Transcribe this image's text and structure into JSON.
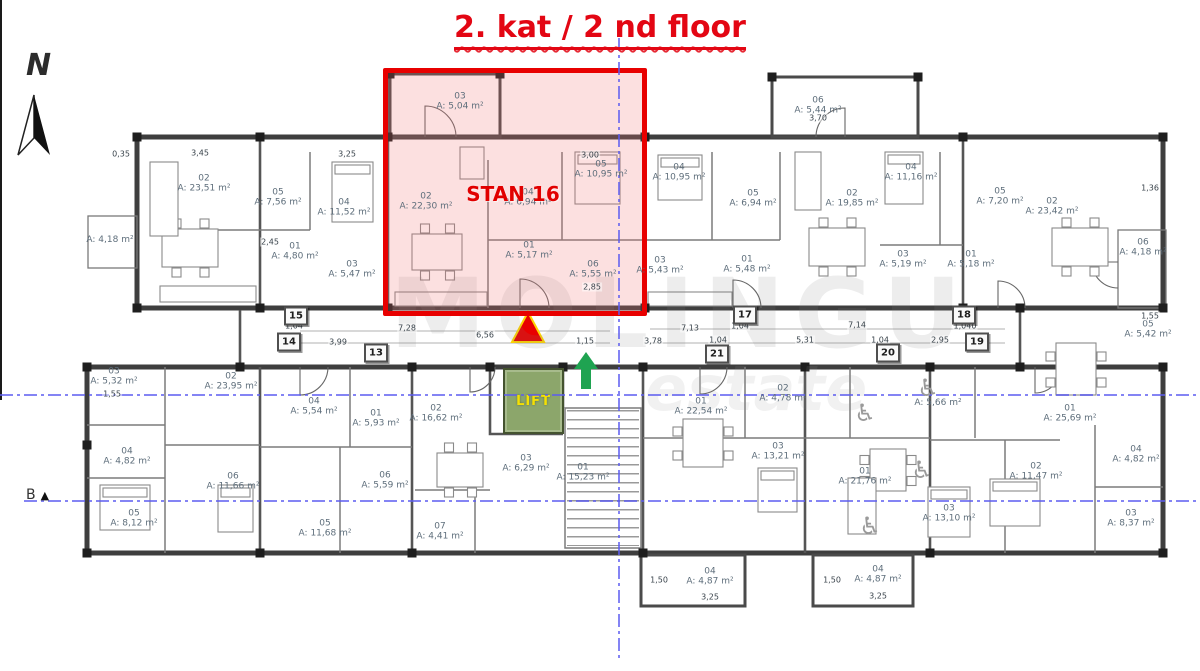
{
  "title": "2. kat / 2 nd floor",
  "compass": {
    "label": "N"
  },
  "highlight": {
    "label": "STAN 16"
  },
  "lift": {
    "label": "LIFT"
  },
  "section_marker": {
    "label": "B",
    "symbol": "▲"
  },
  "watermark": {
    "line1": "MOLINGU",
    "line2": "estate"
  },
  "colors": {
    "highlight_red": "#e80000",
    "highlight_fill": "rgba(242,116,116,0.22)",
    "title_red": "#e30613",
    "lift_green": "#8ca66b",
    "lift_label_yellow": "#f5e003",
    "axis_blue": "#5b5bf0",
    "wall_dark": "#3e3e3e",
    "marker_arrow_green": "#1fa351",
    "marker_triangle_red": "#e80000",
    "marker_triangle_outline": "#ffd400"
  },
  "unit_tags": [
    {
      "label": "15",
      "x": 296,
      "y": 316
    },
    {
      "label": "14",
      "x": 289,
      "y": 342
    },
    {
      "label": "13",
      "x": 376,
      "y": 353
    },
    {
      "label": "17",
      "x": 745,
      "y": 315
    },
    {
      "label": "21",
      "x": 717,
      "y": 354
    },
    {
      "label": "18",
      "x": 964,
      "y": 315
    },
    {
      "label": "19",
      "x": 977,
      "y": 342
    },
    {
      "label": "20",
      "x": 888,
      "y": 353
    }
  ],
  "rooms": [
    {
      "num": "02",
      "area": "A: 23,51 m²",
      "x": 204,
      "y": 184
    },
    {
      "num": "05",
      "area": "A: 7,56 m²",
      "x": 278,
      "y": 198
    },
    {
      "num": "04",
      "area": "A: 11,52 m²",
      "x": 344,
      "y": 208
    },
    {
      "num": "01",
      "area": "A: 4,80 m²",
      "x": 295,
      "y": 252
    },
    {
      "num": "03",
      "area": "A: 5,47 m²",
      "x": 352,
      "y": 270
    },
    {
      "num": "",
      "area": "A: 4,18 m²",
      "x": 110,
      "y": 240
    },
    {
      "num": "03",
      "area": "A: 5,04 m²",
      "x": 460,
      "y": 102
    },
    {
      "num": "02",
      "area": "A: 22,30 m²",
      "x": 426,
      "y": 202
    },
    {
      "num": "05",
      "area": "A: 10,95 m²",
      "x": 601,
      "y": 170
    },
    {
      "num": "04",
      "area": "A: 6,94 m²",
      "x": 528,
      "y": 198
    },
    {
      "num": "01",
      "area": "A: 5,17 m²",
      "x": 529,
      "y": 251
    },
    {
      "num": "06",
      "area": "A: 5,55 m²",
      "x": 593,
      "y": 270
    },
    {
      "num": "06",
      "area": "A: 5,44 m²",
      "x": 818,
      "y": 106
    },
    {
      "num": "04",
      "area": "A: 10,95 m²",
      "x": 679,
      "y": 173
    },
    {
      "num": "05",
      "area": "A: 6,94 m²",
      "x": 753,
      "y": 199
    },
    {
      "num": "02",
      "area": "A: 19,85 m²",
      "x": 852,
      "y": 199
    },
    {
      "num": "03",
      "area": "A: 5,43 m²",
      "x": 660,
      "y": 266
    },
    {
      "num": "01",
      "area": "A: 5,48 m²",
      "x": 747,
      "y": 265
    },
    {
      "num": "04",
      "area": "A: 11,16 m²",
      "x": 911,
      "y": 173
    },
    {
      "num": "05",
      "area": "A: 7,20 m²",
      "x": 1000,
      "y": 197
    },
    {
      "num": "02",
      "area": "A: 23,42 m²",
      "x": 1052,
      "y": 207
    },
    {
      "num": "03",
      "area": "A: 5,19 m²",
      "x": 903,
      "y": 260
    },
    {
      "num": "01",
      "area": "A: 5,18 m²",
      "x": 971,
      "y": 260
    },
    {
      "num": "06",
      "area": "A: 4,18 m²",
      "x": 1143,
      "y": 248
    },
    {
      "num": "03",
      "area": "A: 5,32 m²",
      "x": 114,
      "y": 377
    },
    {
      "num": "02",
      "area": "A: 23,95 m²",
      "x": 231,
      "y": 382
    },
    {
      "num": "04",
      "area": "A: 4,82 m²",
      "x": 127,
      "y": 457
    },
    {
      "num": "06",
      "area": "A: 11,66 m²",
      "x": 233,
      "y": 482
    },
    {
      "num": "05",
      "area": "A: 8,12 m²",
      "x": 134,
      "y": 519
    },
    {
      "num": "04",
      "area": "A: 5,54 m²",
      "x": 314,
      "y": 407
    },
    {
      "num": "01",
      "area": "A: 5,93 m²",
      "x": 376,
      "y": 419
    },
    {
      "num": "02",
      "area": "A: 16,62 m²",
      "x": 436,
      "y": 414
    },
    {
      "num": "06",
      "area": "A: 5,59 m²",
      "x": 385,
      "y": 481
    },
    {
      "num": "05",
      "area": "A: 11,68 m²",
      "x": 325,
      "y": 529
    },
    {
      "num": "07",
      "area": "A: 4,41 m²",
      "x": 440,
      "y": 532
    },
    {
      "num": "03",
      "area": "A: 6,29 m²",
      "x": 526,
      "y": 464
    },
    {
      "num": "01",
      "area": "A: 15,23 m²",
      "x": 583,
      "y": 473
    },
    {
      "num": "01",
      "area": "A: 22,54 m²",
      "x": 701,
      "y": 407
    },
    {
      "num": "02",
      "area": "A: 4,78 m²",
      "x": 783,
      "y": 394
    },
    {
      "num": "03",
      "area": "A: 13,21 m²",
      "x": 778,
      "y": 452
    },
    {
      "num": "01",
      "area": "A: 21,76 m²",
      "x": 865,
      "y": 477
    },
    {
      "num": "04",
      "area": "A: 4,87 m²",
      "x": 710,
      "y": 577
    },
    {
      "num": "04",
      "area": "A: 4,87 m²",
      "x": 878,
      "y": 575
    },
    {
      "num": "",
      "area": "A: 5,66 m²",
      "x": 938,
      "y": 403
    },
    {
      "num": "01",
      "area": "A: 25,69 m²",
      "x": 1070,
      "y": 414
    },
    {
      "num": "02",
      "area": "A: 11,47 m²",
      "x": 1036,
      "y": 472
    },
    {
      "num": "03",
      "area": "A: 13,10 m²",
      "x": 949,
      "y": 514
    },
    {
      "num": "04",
      "area": "A: 4,82 m²",
      "x": 1136,
      "y": 455
    },
    {
      "num": "03",
      "area": "A: 8,37 m²",
      "x": 1131,
      "y": 519
    },
    {
      "num": "05",
      "area": "A: 5,42 m²",
      "x": 1148,
      "y": 330
    }
  ],
  "dims": [
    {
      "label": "1,04",
      "x": 294,
      "y": 326
    },
    {
      "label": "7,28",
      "x": 407,
      "y": 328
    },
    {
      "label": "6,56",
      "x": 485,
      "y": 335
    },
    {
      "label": "3,99",
      "x": 338,
      "y": 342
    },
    {
      "label": "1,15",
      "x": 585,
      "y": 341
    },
    {
      "label": "7,13",
      "x": 690,
      "y": 328
    },
    {
      "label": "1,04",
      "x": 740,
      "y": 326
    },
    {
      "label": "7,14",
      "x": 857,
      "y": 325
    },
    {
      "label": "1,040",
      "x": 965,
      "y": 326
    },
    {
      "label": "3,78",
      "x": 653,
      "y": 341
    },
    {
      "label": "1,04",
      "x": 718,
      "y": 340
    },
    {
      "label": "5,31",
      "x": 805,
      "y": 340
    },
    {
      "label": "1,04",
      "x": 880,
      "y": 340
    },
    {
      "label": "2,95",
      "x": 940,
      "y": 340
    },
    {
      "label": "3,70",
      "x": 818,
      "y": 118
    },
    {
      "label": "3,00",
      "x": 590,
      "y": 155
    },
    {
      "label": "2,85",
      "x": 592,
      "y": 287
    },
    {
      "label": "0,35",
      "x": 121,
      "y": 154
    },
    {
      "label": "3,45",
      "x": 200,
      "y": 153
    },
    {
      "label": "3,25",
      "x": 347,
      "y": 154
    },
    {
      "label": "2,45",
      "x": 270,
      "y": 242
    },
    {
      "label": "1,36",
      "x": 1150,
      "y": 188
    },
    {
      "label": "1,55",
      "x": 1150,
      "y": 316
    },
    {
      "label": "1,55",
      "x": 112,
      "y": 394
    },
    {
      "label": "1,50",
      "x": 659,
      "y": 580
    },
    {
      "label": "3,25",
      "x": 710,
      "y": 597
    },
    {
      "label": "1,50",
      "x": 832,
      "y": 580
    },
    {
      "label": "3,25",
      "x": 878,
      "y": 596
    }
  ],
  "wheelchair_positions": [
    {
      "x": 865,
      "y": 413
    },
    {
      "x": 928,
      "y": 388
    },
    {
      "x": 922,
      "y": 470
    },
    {
      "x": 870,
      "y": 526
    }
  ]
}
